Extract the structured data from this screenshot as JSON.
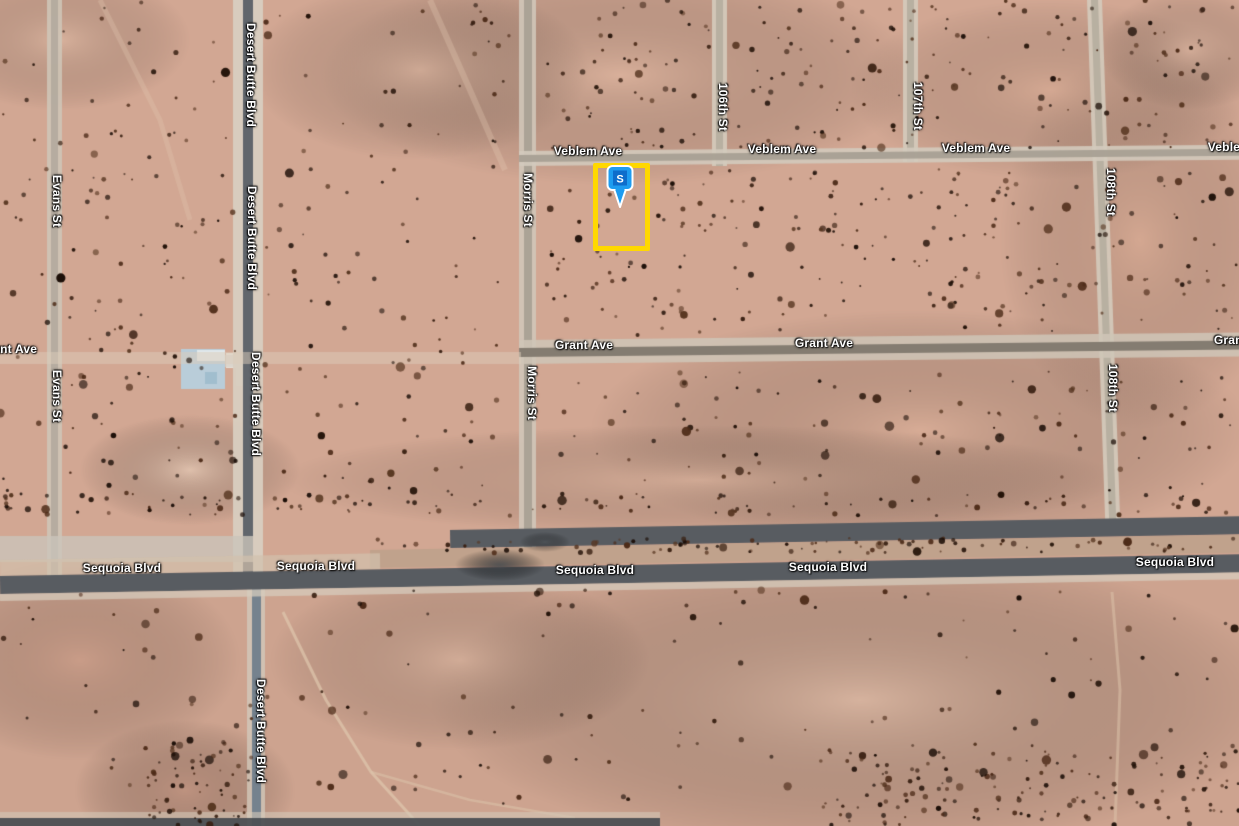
{
  "map": {
    "view_type": "satellite",
    "marker": {
      "letter": "S",
      "head_color": "#1E9CF0",
      "badge_color": "#0E6DCB",
      "outline_color": "#FFFFFF",
      "x": 604,
      "y": 164
    },
    "parcel_outline": {
      "color": "#FFD800",
      "x": 593,
      "y": 163,
      "width": 57,
      "height": 88,
      "stroke_width": 5
    },
    "road_labels": [
      {
        "text": "Evans St",
        "x": 57,
        "y": 201,
        "vertical": true
      },
      {
        "text": "Evans St",
        "x": 57,
        "y": 396,
        "vertical": true
      },
      {
        "text": "Desert Butte Blvd",
        "x": 251,
        "y": 75,
        "vertical": true
      },
      {
        "text": "Desert Butte Blvd",
        "x": 252,
        "y": 238,
        "vertical": true
      },
      {
        "text": "Desert Butte Blvd",
        "x": 256,
        "y": 404,
        "vertical": true
      },
      {
        "text": "Desert Butte Blvd",
        "x": 261,
        "y": 731,
        "vertical": true
      },
      {
        "text": "Morris St",
        "x": 528,
        "y": 200,
        "vertical": true
      },
      {
        "text": "Morris St",
        "x": 532,
        "y": 393,
        "vertical": true
      },
      {
        "text": "106th St",
        "x": 723,
        "y": 107,
        "vertical": true
      },
      {
        "text": "107th St",
        "x": 918,
        "y": 106,
        "vertical": true
      },
      {
        "text": "108th St",
        "x": 1111,
        "y": 192,
        "vertical": true
      },
      {
        "text": "108th St",
        "x": 1113,
        "y": 388,
        "vertical": true
      },
      {
        "text": "Veblem Ave",
        "x": 588,
        "y": 151,
        "vertical": false
      },
      {
        "text": "Veblem Ave",
        "x": 782,
        "y": 149,
        "vertical": false
      },
      {
        "text": "Veblem Ave",
        "x": 976,
        "y": 148,
        "vertical": false
      },
      {
        "text": "Veblem Ave",
        "x": 1242,
        "y": 147,
        "vertical": false
      },
      {
        "text": "Grant Ave",
        "x": 8,
        "y": 349,
        "vertical": false
      },
      {
        "text": "Grant Ave",
        "x": 584,
        "y": 345,
        "vertical": false
      },
      {
        "text": "Grant Ave",
        "x": 824,
        "y": 343,
        "vertical": false
      },
      {
        "text": "Grant Ave",
        "x": 1243,
        "y": 340,
        "vertical": false
      },
      {
        "text": "Sequoia Blvd",
        "x": 122,
        "y": 568,
        "vertical": false
      },
      {
        "text": "Sequoia Blvd",
        "x": 316,
        "y": 566,
        "vertical": false
      },
      {
        "text": "Sequoia Blvd",
        "x": 595,
        "y": 570,
        "vertical": false
      },
      {
        "text": "Sequoia Blvd",
        "x": 828,
        "y": 567,
        "vertical": false
      },
      {
        "text": "Sequoia Blvd",
        "x": 1175,
        "y": 562,
        "vertical": false
      }
    ],
    "roads": [
      {
        "id": "evans-st",
        "name": "Evans St",
        "o": "v",
        "x": 47,
        "y": 0,
        "len": 580,
        "rot": 0,
        "layers": [
          [
            0,
            15,
            "#cfc7b9",
            0.85
          ],
          [
            4,
            7,
            "#b2aa9d",
            0.9
          ]
        ]
      },
      {
        "id": "desert-butte-north",
        "name": "Desert Butte Blvd",
        "o": "v",
        "x": 233,
        "y": 0,
        "len": 580,
        "rot": 0,
        "layers": [
          [
            0,
            30,
            "#d8cec0",
            0.95
          ],
          [
            10,
            10,
            "#61666c",
            1
          ]
        ]
      },
      {
        "id": "desert-butte-south",
        "name": "Desert Butte Blvd",
        "o": "v",
        "x": 247,
        "y": 574,
        "len": 256,
        "rot": 0,
        "layers": [
          [
            0,
            18,
            "#d2c8ba",
            0.8
          ],
          [
            5,
            9,
            "#75828e",
            1
          ]
        ]
      },
      {
        "id": "morris-st",
        "name": "Morris St",
        "o": "v",
        "x": 519,
        "y": 0,
        "len": 548,
        "rot": 0,
        "layers": [
          [
            0,
            17,
            "#d0c7b9",
            0.9
          ],
          [
            5,
            8,
            "#a9a195",
            0.95
          ]
        ]
      },
      {
        "id": "106th-st",
        "name": "106th St",
        "o": "v",
        "x": 712,
        "y": 0,
        "len": 166,
        "rot": 0,
        "layers": [
          [
            0,
            15,
            "#d4cbbd",
            0.9
          ],
          [
            4,
            7,
            "#b5ad9f",
            0.9
          ]
        ]
      },
      {
        "id": "107th-st",
        "name": "107th St",
        "o": "v",
        "x": 903,
        "y": 0,
        "len": 162,
        "rot": 0,
        "layers": [
          [
            0,
            15,
            "#d4cbbd",
            0.9
          ],
          [
            4,
            7,
            "#b5ad9f",
            0.9
          ]
        ]
      },
      {
        "id": "108th-st",
        "name": "108th St",
        "o": "v",
        "x": 1087,
        "y": 0,
        "len": 530,
        "rot": -2,
        "layers": [
          [
            0,
            15,
            "#d4cbbd",
            0.9
          ],
          [
            4,
            7,
            "#b5ad9f",
            0.9
          ]
        ]
      },
      {
        "id": "veblem-ave",
        "name": "Veblem Ave",
        "o": "h",
        "x": 519,
        "y": 151,
        "len": 720,
        "rot": -0.5,
        "layers": [
          [
            0,
            15,
            "#d3cabc",
            0.9
          ],
          [
            4,
            7,
            "#a8a094",
            0.95
          ]
        ]
      },
      {
        "id": "grant-ave-east",
        "name": "Grant Ave",
        "o": "h",
        "x": 519,
        "y": 340,
        "len": 720,
        "rot": -0.6,
        "layers": [
          [
            0,
            24,
            "#cfc5b7",
            0.85
          ],
          [
            8,
            9,
            "#847c71",
            1
          ]
        ]
      },
      {
        "id": "grant-ave-west",
        "name": "Grant Ave",
        "o": "h",
        "x": 0,
        "y": 352,
        "len": 521,
        "rot": 0,
        "layers": [
          [
            0,
            12,
            "#dcccba",
            0.5
          ]
        ]
      },
      {
        "id": "sequoia-nw-band",
        "name": "Sequoia Blvd",
        "o": "h",
        "x": 0,
        "y": 536,
        "len": 253,
        "rot": 0,
        "layers": [
          [
            0,
            26,
            "#cbc4ba",
            0.8
          ]
        ]
      },
      {
        "id": "sequoia-north-lane",
        "name": "Sequoia Blvd",
        "o": "h",
        "x": 450,
        "y": 530,
        "len": 795,
        "rot": -1,
        "layers": [
          [
            0,
            18,
            "#585c61",
            1
          ]
        ]
      },
      {
        "id": "sequoia-median",
        "name": "Sequoia Blvd",
        "o": "h",
        "x": 370,
        "y": 550,
        "len": 875,
        "rot": -1,
        "layers": [
          [
            0,
            18,
            "#c0a28c",
            1
          ]
        ]
      },
      {
        "id": "sequoia-shoulder-n",
        "name": "Sequoia Blvd",
        "o": "h",
        "x": 0,
        "y": 560,
        "len": 380,
        "rot": -1,
        "layers": [
          [
            0,
            16,
            "#d2c0ac",
            0.7
          ]
        ]
      },
      {
        "id": "sequoia-south-lane",
        "name": "Sequoia Blvd",
        "o": "h",
        "x": 0,
        "y": 576,
        "len": 1245,
        "rot": -1,
        "layers": [
          [
            0,
            18,
            "#585c61",
            1
          ]
        ]
      },
      {
        "id": "sequoia-shoulder-s",
        "name": "Sequoia Blvd",
        "o": "h",
        "x": 0,
        "y": 594,
        "len": 1245,
        "rot": -1,
        "layers": [
          [
            0,
            7,
            "#d6cbbc",
            0.75
          ]
        ]
      },
      {
        "id": "bottom-edge-road",
        "name": "",
        "o": "h",
        "x": 0,
        "y": 812,
        "len": 660,
        "rot": 0,
        "layers": [
          [
            0,
            6,
            "#d4c8b8",
            0.6
          ],
          [
            6,
            8,
            "#4c5054",
            0.95
          ]
        ]
      }
    ],
    "terrain": {
      "base_color": "#d2a793",
      "south_overlay_color": "#c79d8a",
      "bush_color": "#2a170d",
      "building_roof_color": "#b7cfdc"
    }
  }
}
